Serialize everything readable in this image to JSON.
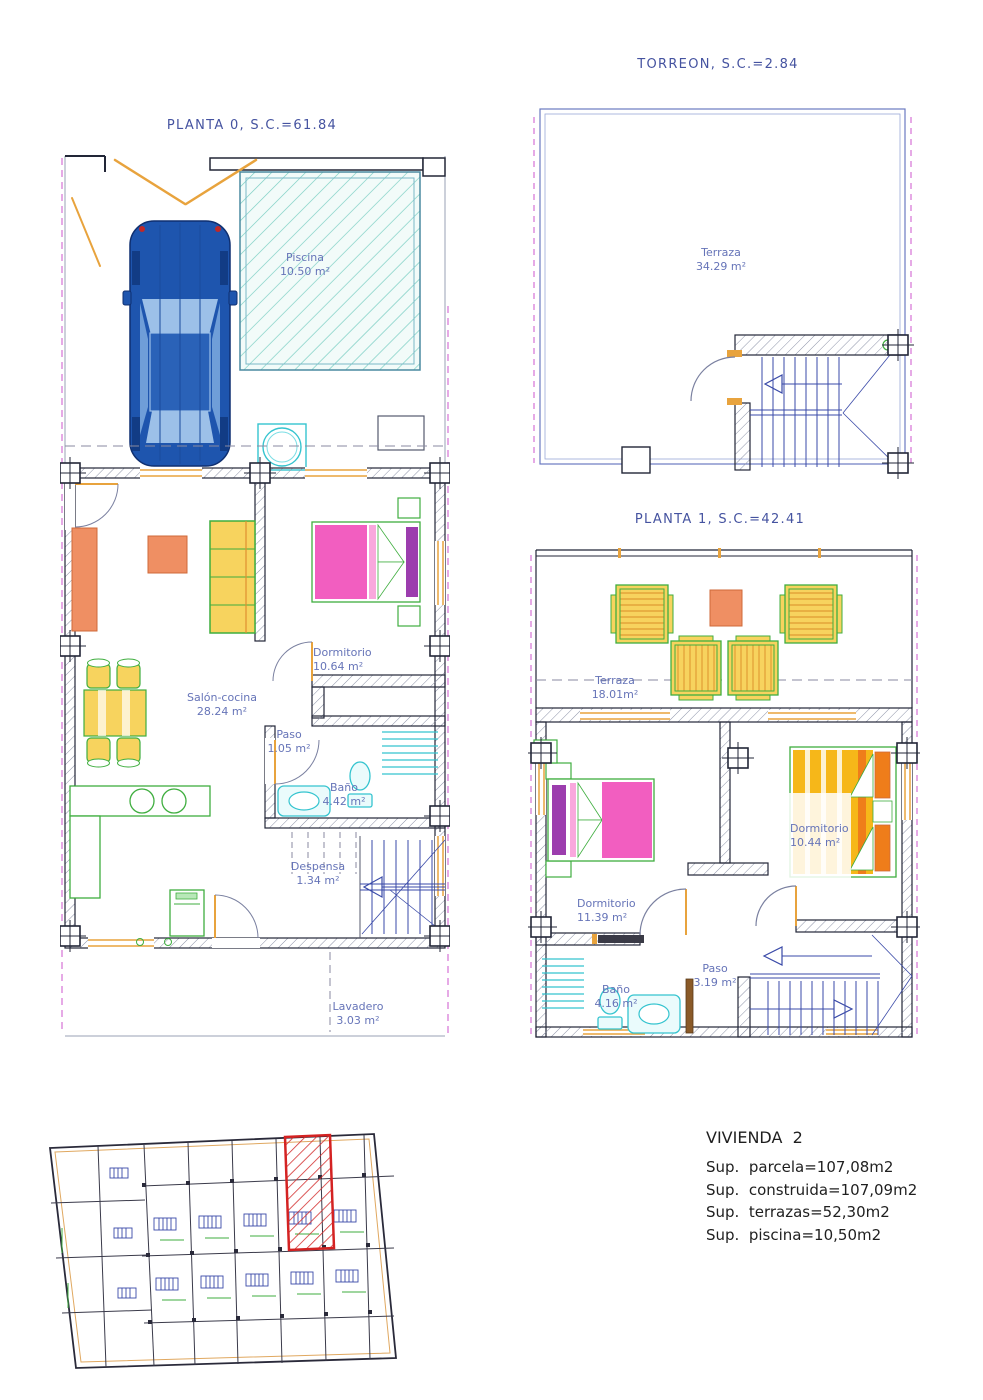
{
  "document": {
    "type": "architectural floor plan drawing"
  },
  "plans": {
    "planta0": {
      "title": "PLANTA 0, S.C.=61.84",
      "rooms": [
        {
          "name": "Piscina",
          "area": "10.50 m²"
        },
        {
          "name": "Dormitorio",
          "area": "10.64 m²"
        },
        {
          "name": "Salón-cocina",
          "area": "28.24 m²"
        },
        {
          "name": "Paso",
          "area": "1.05 m²"
        },
        {
          "name": "Baño",
          "area": "4.42 m²"
        },
        {
          "name": "Despensa",
          "area": "1.34 m²"
        },
        {
          "name": "Lavadero",
          "area": "3.03 m²"
        }
      ]
    },
    "torreon": {
      "title": "TORREON, S.C.=2.84",
      "rooms": [
        {
          "name": "Terraza",
          "area": "34.29 m²"
        }
      ]
    },
    "planta1": {
      "title": "PLANTA 1, S.C.=42.41",
      "rooms": [
        {
          "name": "Terraza",
          "area": "18.01m²"
        },
        {
          "name": "Dormitorio",
          "area": "11.39 m²"
        },
        {
          "name": "Dormitorio",
          "area": "10.44 m²"
        },
        {
          "name": "Paso",
          "area": "3.19 m²"
        },
        {
          "name": "Baño",
          "area": "4.16 m²"
        }
      ]
    }
  },
  "summary": {
    "title": "VIVIENDA  2",
    "lines": [
      "Sup.  parcela=107,08m2",
      "Sup.  construida=107,09m2",
      "Sup.  terrazas=52,30m2",
      "Sup.  piscina=10,50m2"
    ]
  },
  "colors": {
    "title_blue": "#4553a0",
    "label_blue": "#6674b8",
    "wall_dark": "#222637",
    "cad_orange": "#e8a33d",
    "furniture_yellow": "#f7d35e",
    "furniture_green": "#3fae3f",
    "bed_pink": "#f25ec0",
    "pillow_purple": "#9c3dae",
    "bed_orange": "#f6b719",
    "pillow_orange": "#ef7d1a",
    "bath_cyan": "#35c4cf",
    "stair_blue": "#3a4aa8",
    "car_blue": "#1e55ae",
    "pool_teal": "#74ccc0",
    "property_magenta": "#cc55cc",
    "highlight_red": "#d42222"
  }
}
